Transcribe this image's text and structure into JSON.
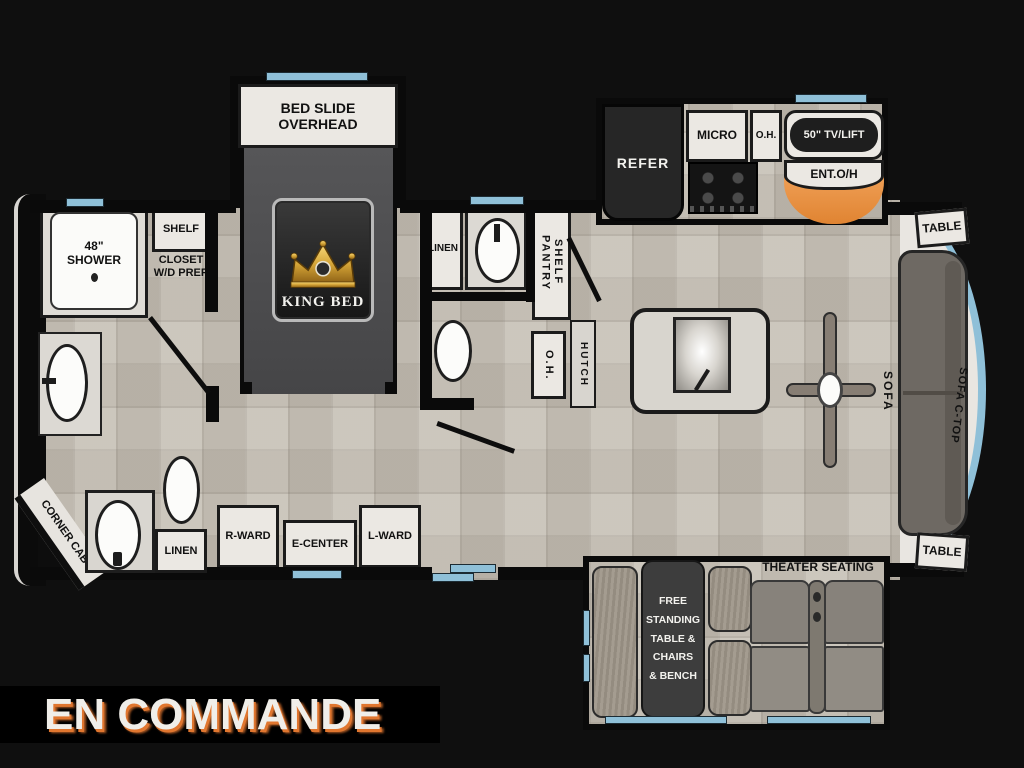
{
  "banner": {
    "label": "EN COMMANDE"
  },
  "palette": {
    "background": "#0f0f0f",
    "wall": "#0a0a0a",
    "floor": "#c8c3b9",
    "slide_trim_blue": "#8fc0d8",
    "fireplace_orange": "#e8954a",
    "cabinet_white": "#ebe8e3",
    "bed_platform_gray": "#4b4b4d",
    "appliance_dark": "#262626",
    "sofa_gray": "#6f6a63",
    "crown_gold": "#d4a437"
  },
  "labels": {
    "bed_slide": "BED SLIDE\nOVERHEAD",
    "king_bed": "KING BED",
    "shower": "48\"\nSHOWER",
    "shelf": "SHELF",
    "closet": "CLOSET\nW/D PREP",
    "linen_front": "LINEN",
    "corner_cab": "CORNER CAB",
    "r_ward": "R-WARD",
    "e_center": "E-CENTER",
    "l_ward": "L-WARD",
    "linen_mid": "LINEN",
    "pantry_shelf": "PANTRY\nSHELF",
    "oh_mid": "O.H.",
    "hutch": "HUTCH",
    "refer": "REFER",
    "micro": "MICRO",
    "oh_kitchen": "O.H.",
    "tv_lift": "50\" TV/LIFT",
    "ent_oh": "ENT.O/H",
    "table_rear_top": "TABLE",
    "table_rear_bottom": "TABLE",
    "sofa": "SOFA",
    "sofa_ctop": "SOFA C-TOP",
    "theater_seating": "THEATER SEATING",
    "dinette": "FREE\nSTANDING\nTABLE &\nCHAIRS\n& BENCH"
  }
}
